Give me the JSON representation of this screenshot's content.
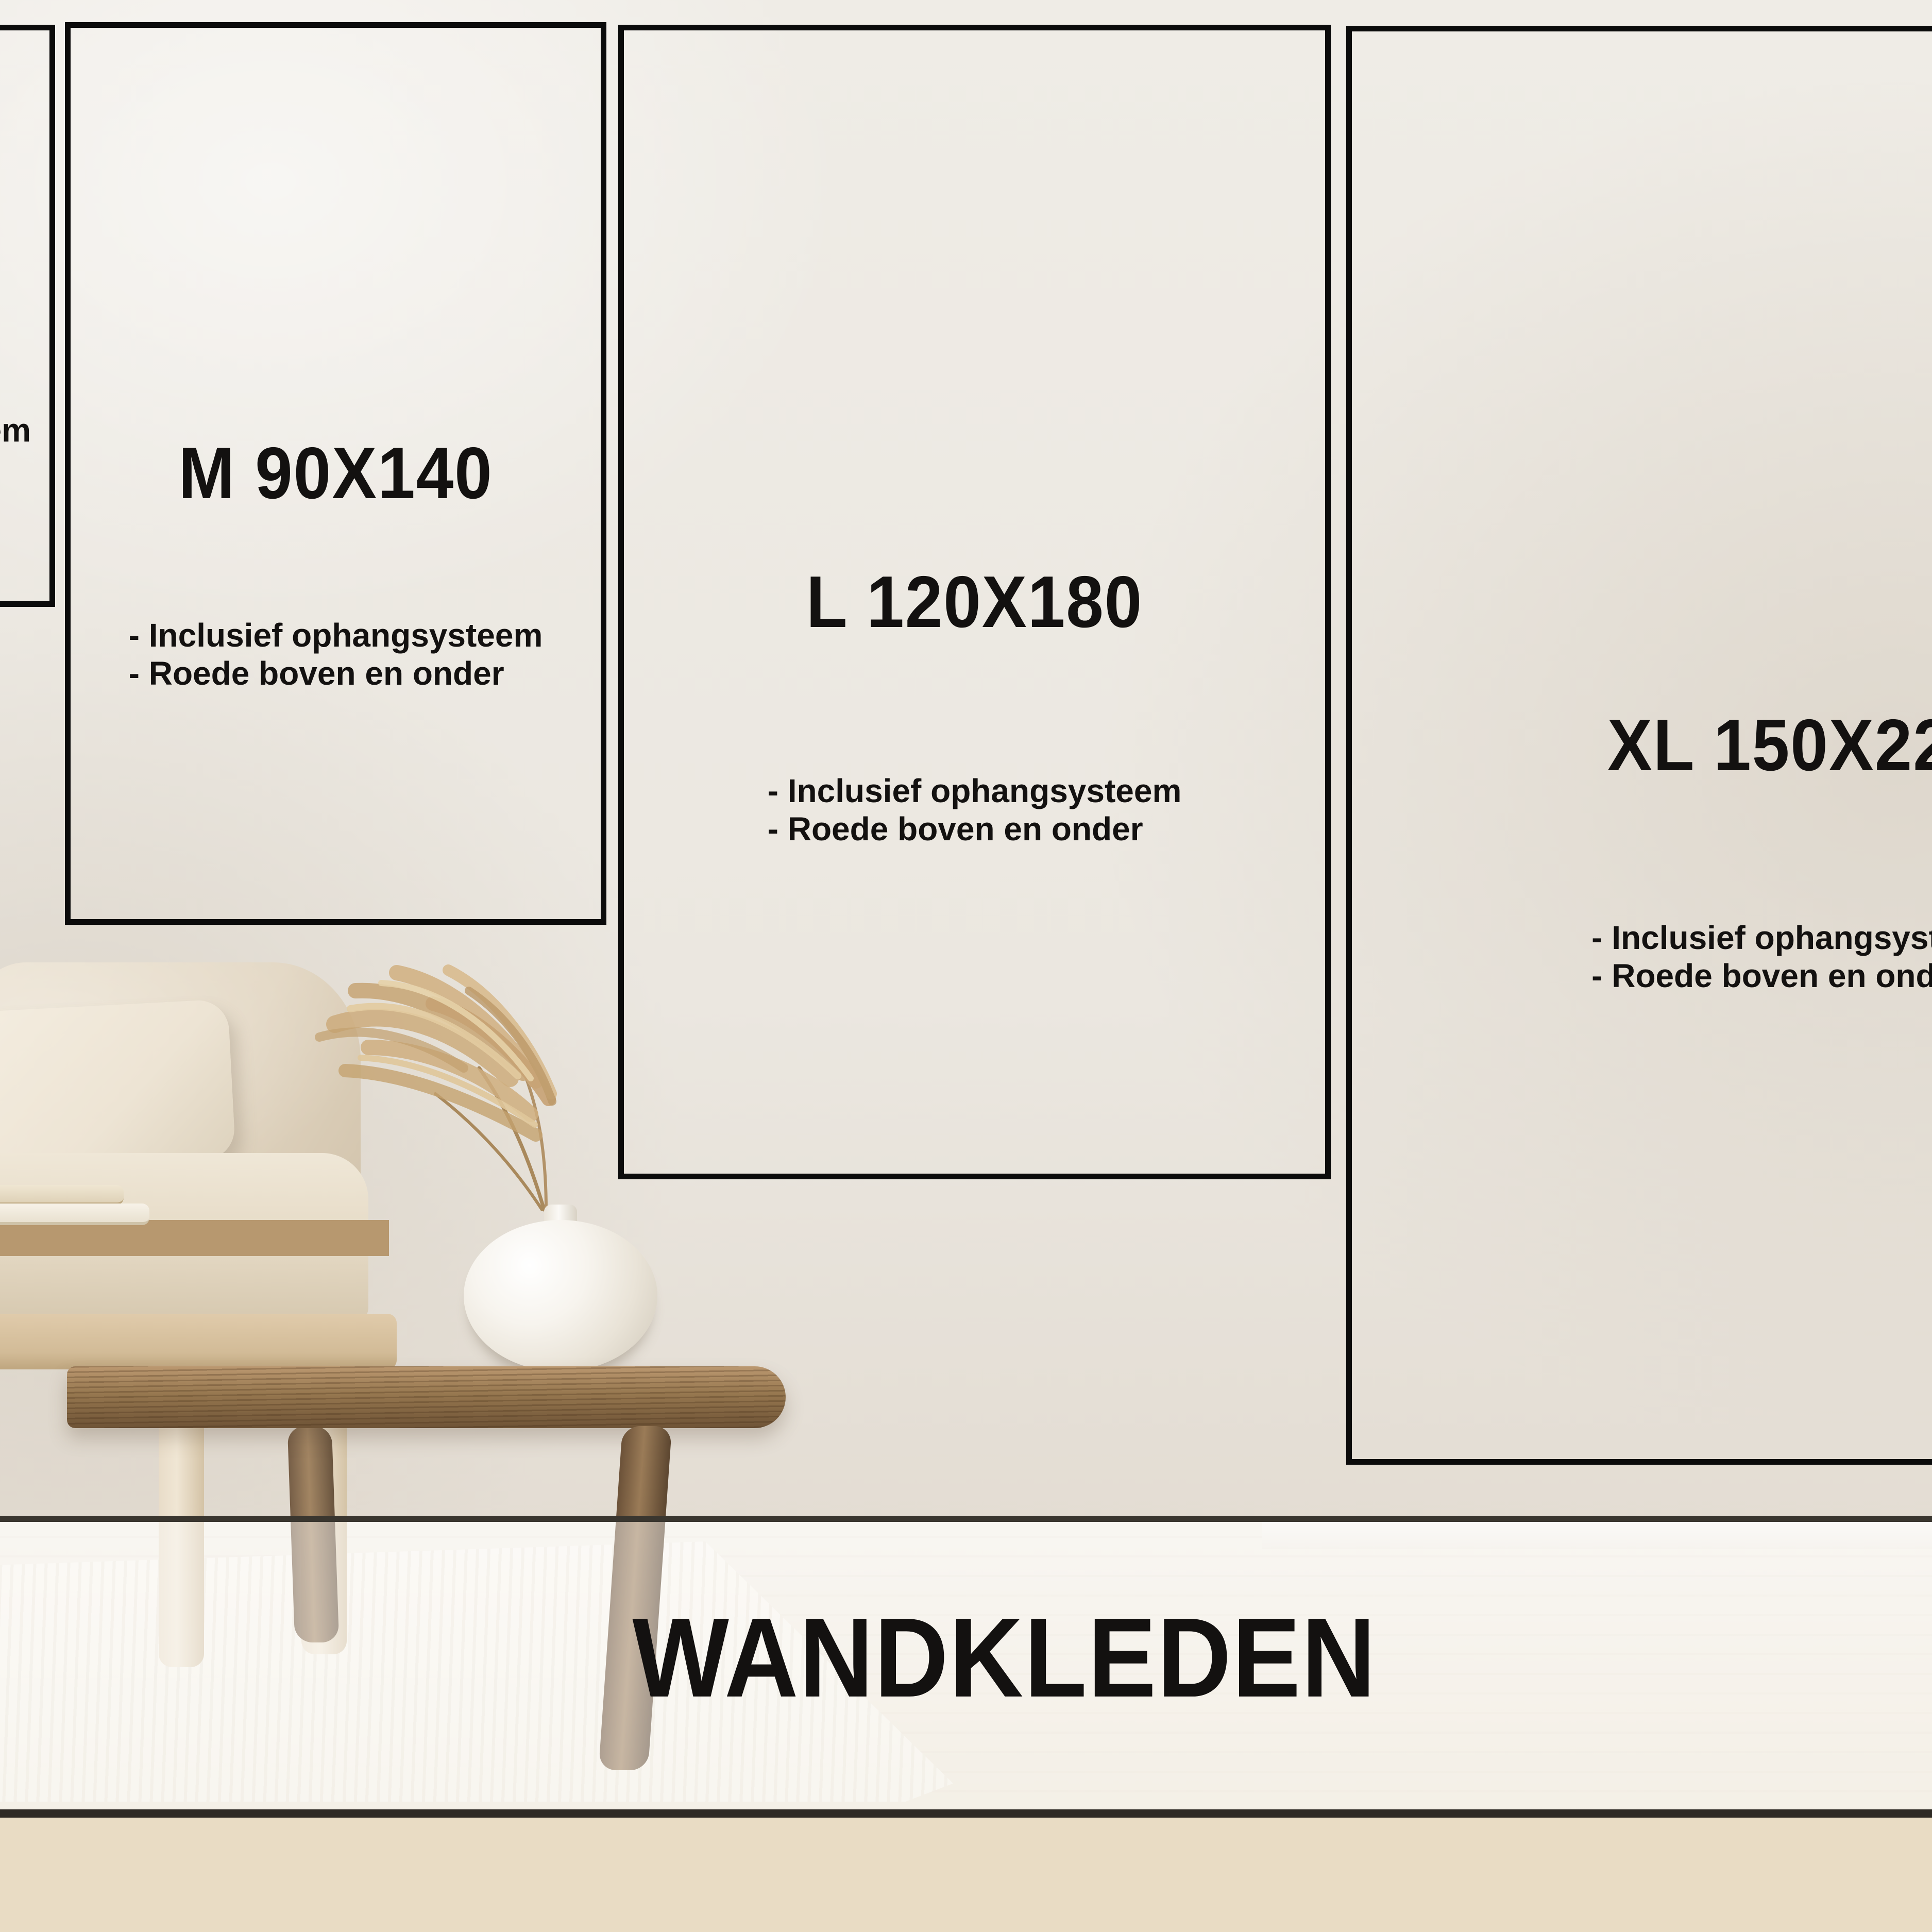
{
  "page_title": "WANDKLEDEN",
  "size_boxes": [
    {
      "id": "s",
      "visible_fragment": "em"
    },
    {
      "id": "m",
      "label": "M 90X140",
      "features": [
        "- Inclusief ophangsysteem",
        "- Roede boven en onder"
      ]
    },
    {
      "id": "l",
      "label": "L 120X180",
      "features": [
        "- Inclusief ophangsysteem",
        "- Roede boven en onder"
      ]
    },
    {
      "id": "xl",
      "label": "XL 150X220",
      "features": [
        "- Inclusief ophangsysteem",
        "- Roede boven en onder"
      ]
    }
  ],
  "colors": {
    "box_border": "#0b0b0b",
    "text": "#131110",
    "band_line_top": "#3a362f",
    "band_line_bottom": "#2e2a25",
    "band_fill": "rgba(255,255,255,0.45)",
    "wall": "#ebe7e0",
    "foreground_wood": "#e9dcc4"
  }
}
